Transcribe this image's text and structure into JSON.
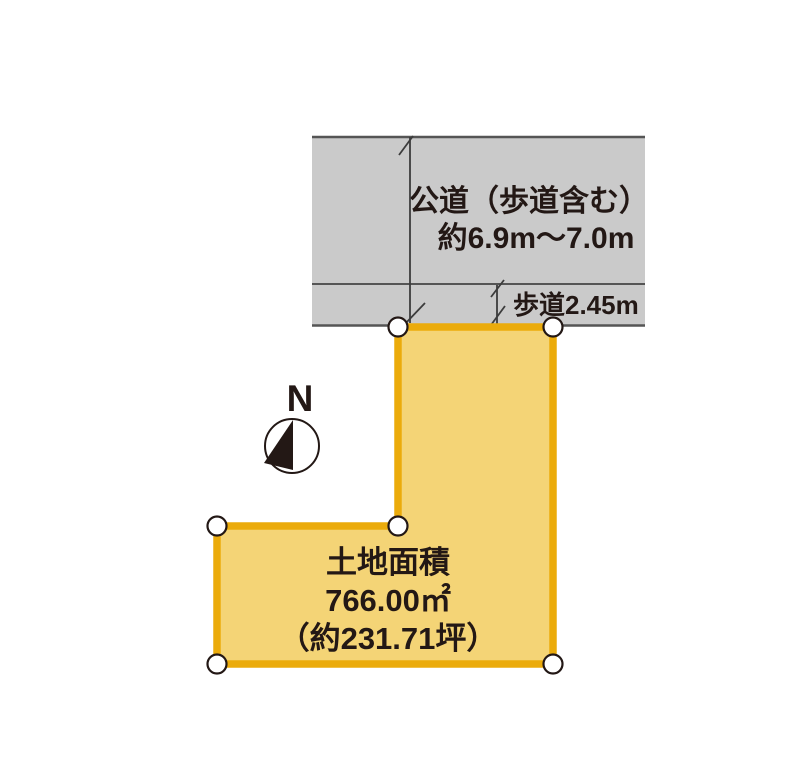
{
  "diagram": {
    "road": {
      "name_line1": "公道（歩道含む）",
      "name_line2": "約6.9m〜7.0m",
      "sidewalk_label": "歩道2.45m"
    },
    "compass": {
      "north": "N"
    },
    "parcel": {
      "title": "土地面積",
      "area_m2": "766.00㎡",
      "area_tsubo": "（約231.71坪）"
    },
    "colors": {
      "background": "#ffffff",
      "road_fill": "#cacaca",
      "road_line": "#555555",
      "dim_line": "#3c3c3c",
      "parcel_fill": "#f4d476",
      "parcel_stroke": "#ebab0b",
      "ink": "#231815",
      "marker_fill": "#ffffff"
    }
  }
}
